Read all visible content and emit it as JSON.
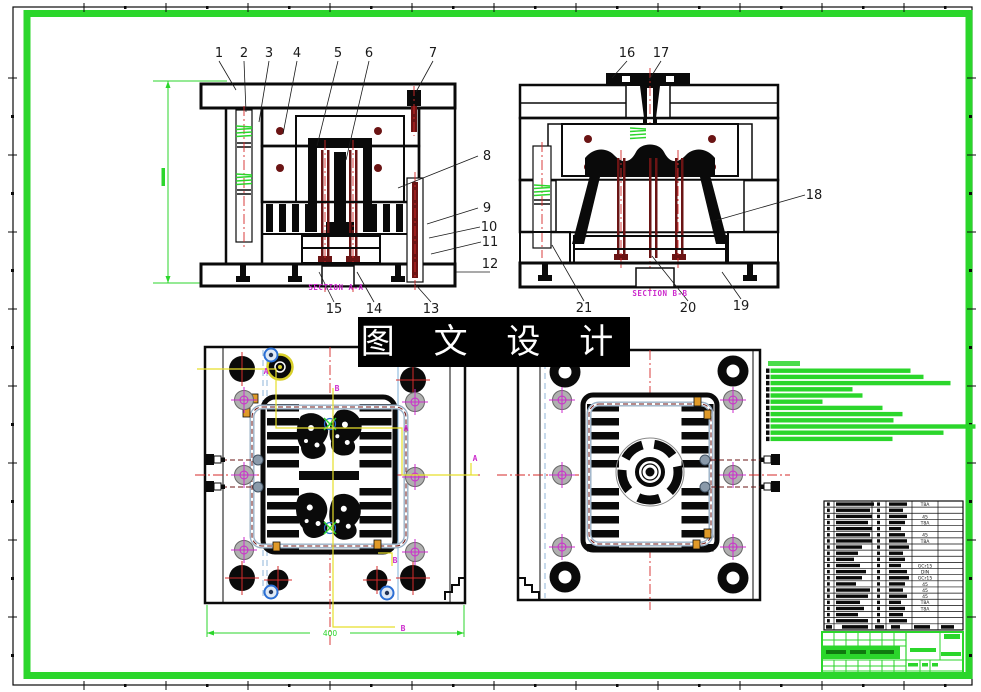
{
  "sheet": {
    "background": "#ffffff",
    "frame_color": "#2bd62b",
    "line_color": "#0a0a0a"
  },
  "watermark": {
    "text": "图 文 设 计",
    "bg": "#000000",
    "fg": "#ffffff"
  },
  "views": {
    "section_a": {
      "label": "SECTION A-A"
    },
    "section_b": {
      "label": "SECTION B-B"
    }
  },
  "dimensions": {
    "plan_width": "400"
  },
  "colors": {
    "pin": "#6b1414",
    "centerline": "#d42a2a",
    "magenta": "#cc2bcc",
    "yellow": "#e6df2a",
    "blue": "#2b6fd4",
    "steel": "#9ab0c6",
    "orange": "#e09a28",
    "gray": "#a8a8a8",
    "green": "#2bd62b"
  },
  "callouts": [
    {
      "n": "1",
      "tx": 219,
      "ty": 57,
      "lx": 236,
      "ly": 90
    },
    {
      "n": "2",
      "tx": 244,
      "ty": 57,
      "lx": 246,
      "ly": 112
    },
    {
      "n": "3",
      "tx": 269,
      "ty": 57,
      "lx": 259,
      "ly": 122
    },
    {
      "n": "4",
      "tx": 297,
      "ty": 57,
      "lx": 283,
      "ly": 134
    },
    {
      "n": "5",
      "tx": 338,
      "ty": 57,
      "lx": 317,
      "ly": 146
    },
    {
      "n": "6",
      "tx": 369,
      "ty": 57,
      "lx": 346,
      "ly": 160
    },
    {
      "n": "7",
      "tx": 433,
      "ty": 57,
      "lx": 416,
      "ly": 92
    },
    {
      "n": "8",
      "tx": 487,
      "ty": 160,
      "lx": 398,
      "ly": 188
    },
    {
      "n": "9",
      "tx": 487,
      "ty": 212,
      "lx": 427,
      "ly": 224
    },
    {
      "n": "10",
      "tx": 489,
      "ty": 231,
      "lx": 429,
      "ly": 238
    },
    {
      "n": "11",
      "tx": 490,
      "ty": 246,
      "lx": 431,
      "ly": 254
    },
    {
      "n": "12",
      "tx": 490,
      "ty": 268,
      "lx": 456,
      "ly": 272
    },
    {
      "n": "13",
      "tx": 431,
      "ty": 313,
      "lx": 415,
      "ly": 284
    },
    {
      "n": "14",
      "tx": 374,
      "ty": 313,
      "lx": 357,
      "ly": 272
    },
    {
      "n": "15",
      "tx": 334,
      "ty": 313,
      "lx": 319,
      "ly": 272
    },
    {
      "n": "16",
      "tx": 627,
      "ty": 57,
      "lx": 612,
      "ly": 78
    },
    {
      "n": "17",
      "tx": 661,
      "ty": 57,
      "lx": 649,
      "ly": 80
    },
    {
      "n": "18",
      "tx": 814,
      "ty": 199,
      "lx": 714,
      "ly": 221
    },
    {
      "n": "19",
      "tx": 741,
      "ty": 310,
      "lx": 722,
      "ly": 272
    },
    {
      "n": "20",
      "tx": 688,
      "ty": 312,
      "lx": 652,
      "ly": 256
    },
    {
      "n": "21",
      "tx": 584,
      "ty": 312,
      "lx": 552,
      "ly": 245
    }
  ],
  "section_letters": [
    {
      "t": "A",
      "x": 266,
      "y": 374
    },
    {
      "t": "A",
      "x": 406,
      "y": 431
    },
    {
      "t": "A",
      "x": 475,
      "y": 461
    },
    {
      "t": "B",
      "x": 337,
      "y": 391
    },
    {
      "t": "B",
      "x": 395,
      "y": 563
    },
    {
      "t": "B",
      "x": 403,
      "y": 631
    }
  ],
  "tech_notes": {
    "bars": [
      140,
      153,
      180,
      82,
      92,
      52,
      112,
      132,
      123,
      205,
      173,
      122
    ]
  },
  "bom": {
    "rows": [
      {
        "w1": 38,
        "w2": 18,
        "note": "T8A"
      },
      {
        "w1": 34,
        "w2": 14,
        "note": ""
      },
      {
        "w1": 36,
        "w2": 18,
        "note": "45"
      },
      {
        "w1": 32,
        "w2": 16,
        "note": "T8A"
      },
      {
        "w1": 36,
        "w2": 12,
        "note": ""
      },
      {
        "w1": 34,
        "w2": 16,
        "note": "45"
      },
      {
        "w1": 36,
        "w2": 18,
        "note": "T8A"
      },
      {
        "w1": 26,
        "w2": 20,
        "note": ""
      },
      {
        "w1": 22,
        "w2": 14,
        "note": ""
      },
      {
        "w1": 18,
        "w2": 16,
        "note": ""
      },
      {
        "w1": 24,
        "w2": 12,
        "note": "GCr15"
      },
      {
        "w1": 30,
        "w2": 18,
        "note": "DIN"
      },
      {
        "w1": 26,
        "w2": 20,
        "note": "GCr15"
      },
      {
        "w1": 20,
        "w2": 16,
        "note": "45"
      },
      {
        "w1": 34,
        "w2": 14,
        "note": "45"
      },
      {
        "w1": 32,
        "w2": 18,
        "note": "45"
      },
      {
        "w1": 24,
        "w2": 12,
        "note": "T8A"
      },
      {
        "w1": 28,
        "w2": 16,
        "note": "T8A"
      },
      {
        "w1": 22,
        "w2": 14,
        "note": ""
      },
      {
        "w1": 32,
        "w2": 18,
        "note": ""
      }
    ],
    "header_bars": [
      [
        826,
        6
      ],
      [
        842,
        26
      ],
      [
        875,
        9
      ],
      [
        891,
        9
      ],
      [
        914,
        16
      ],
      [
        941,
        13
      ]
    ]
  }
}
